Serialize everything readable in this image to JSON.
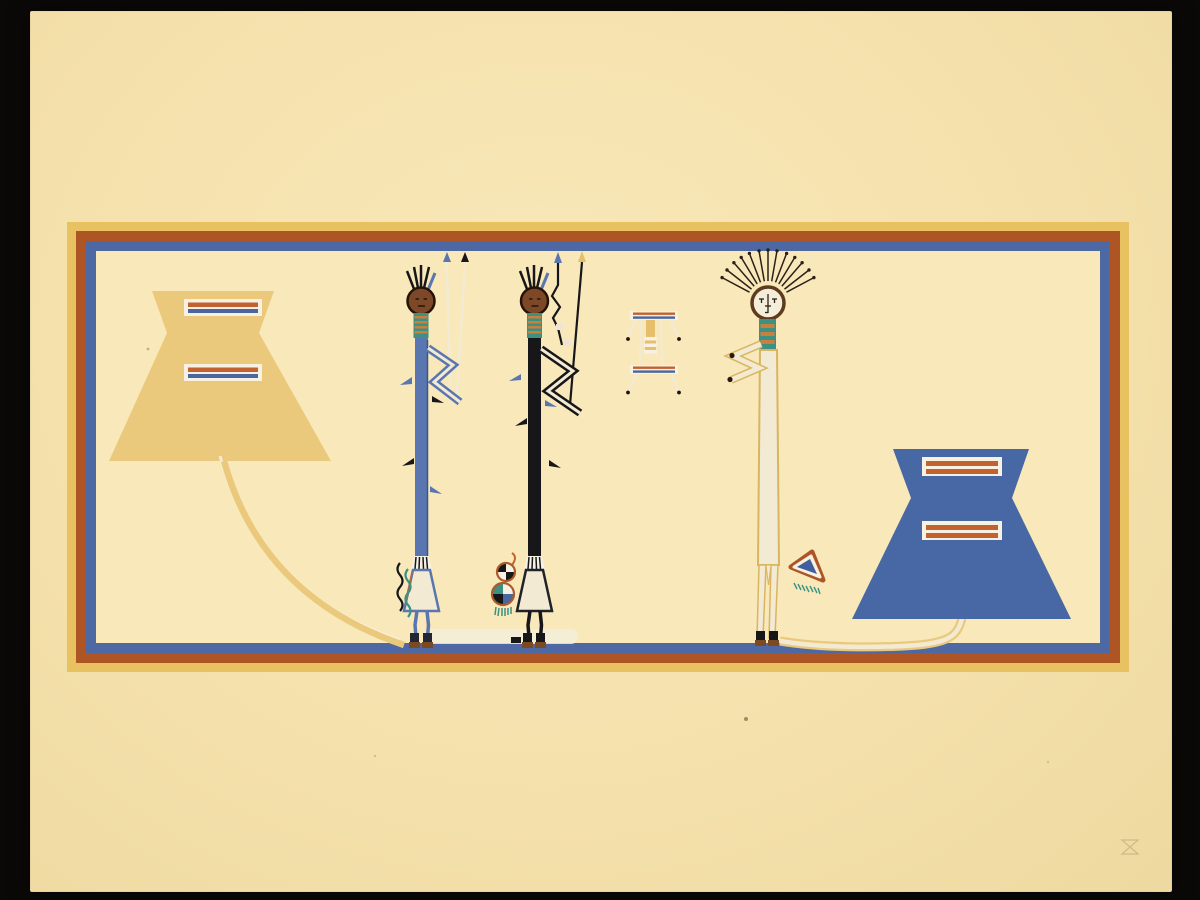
{
  "scene": {
    "kind": "photograph of a screen-print artwork on cream paper over a black ground",
    "motifs": "two striped cloud (hourglass) motifs, a blue Yei figure, a black Yei figure, a small ceremonial stand, a tall white Yei with radiating feather headdress, a gourd pouch, a fringed triangle pouch, rainbow guardian lines, triple-band rectangular border",
    "visible_text": "",
    "blind_stamp": "faint embossed mark, lower right of paper"
  },
  "counts": {
    "headdress_rays": 13,
    "left_cloud_bars": 2,
    "right_cloud_bars": 2,
    "head_feathers_per_dark_figure": 5
  },
  "palette": {
    "photo-black": "#0b0908",
    "paper": "#f5e1ac",
    "paper-light": "#f8e8ba",
    "paper-edge": "#eed9a0",
    "panel-interior": "#f9e8ba",
    "border-yellow": "#e8c160",
    "border-orange": "#ae5526",
    "border-blue": "#4d68a2",
    "cloud-gold": "#ebc97c",
    "cloud-blue": "#4768a4",
    "bar-white": "#f6f1e2",
    "stripe-orange": "#c2622e",
    "stripe-blue": "#49669e",
    "figure-blue": "#5a76b0",
    "ink-black": "#17171a",
    "head-brown": "#7d4827",
    "head-outline": "#241307",
    "teal": "#3d9183",
    "neck-stripe": "#c8803c",
    "cream": "#f3ead4",
    "gold-outline": "#d9b561",
    "moccasin": "#7c4a22",
    "ray-dark": "#2b2119",
    "speck": "#7a6a4a",
    "stamp": "#8a7750"
  }
}
